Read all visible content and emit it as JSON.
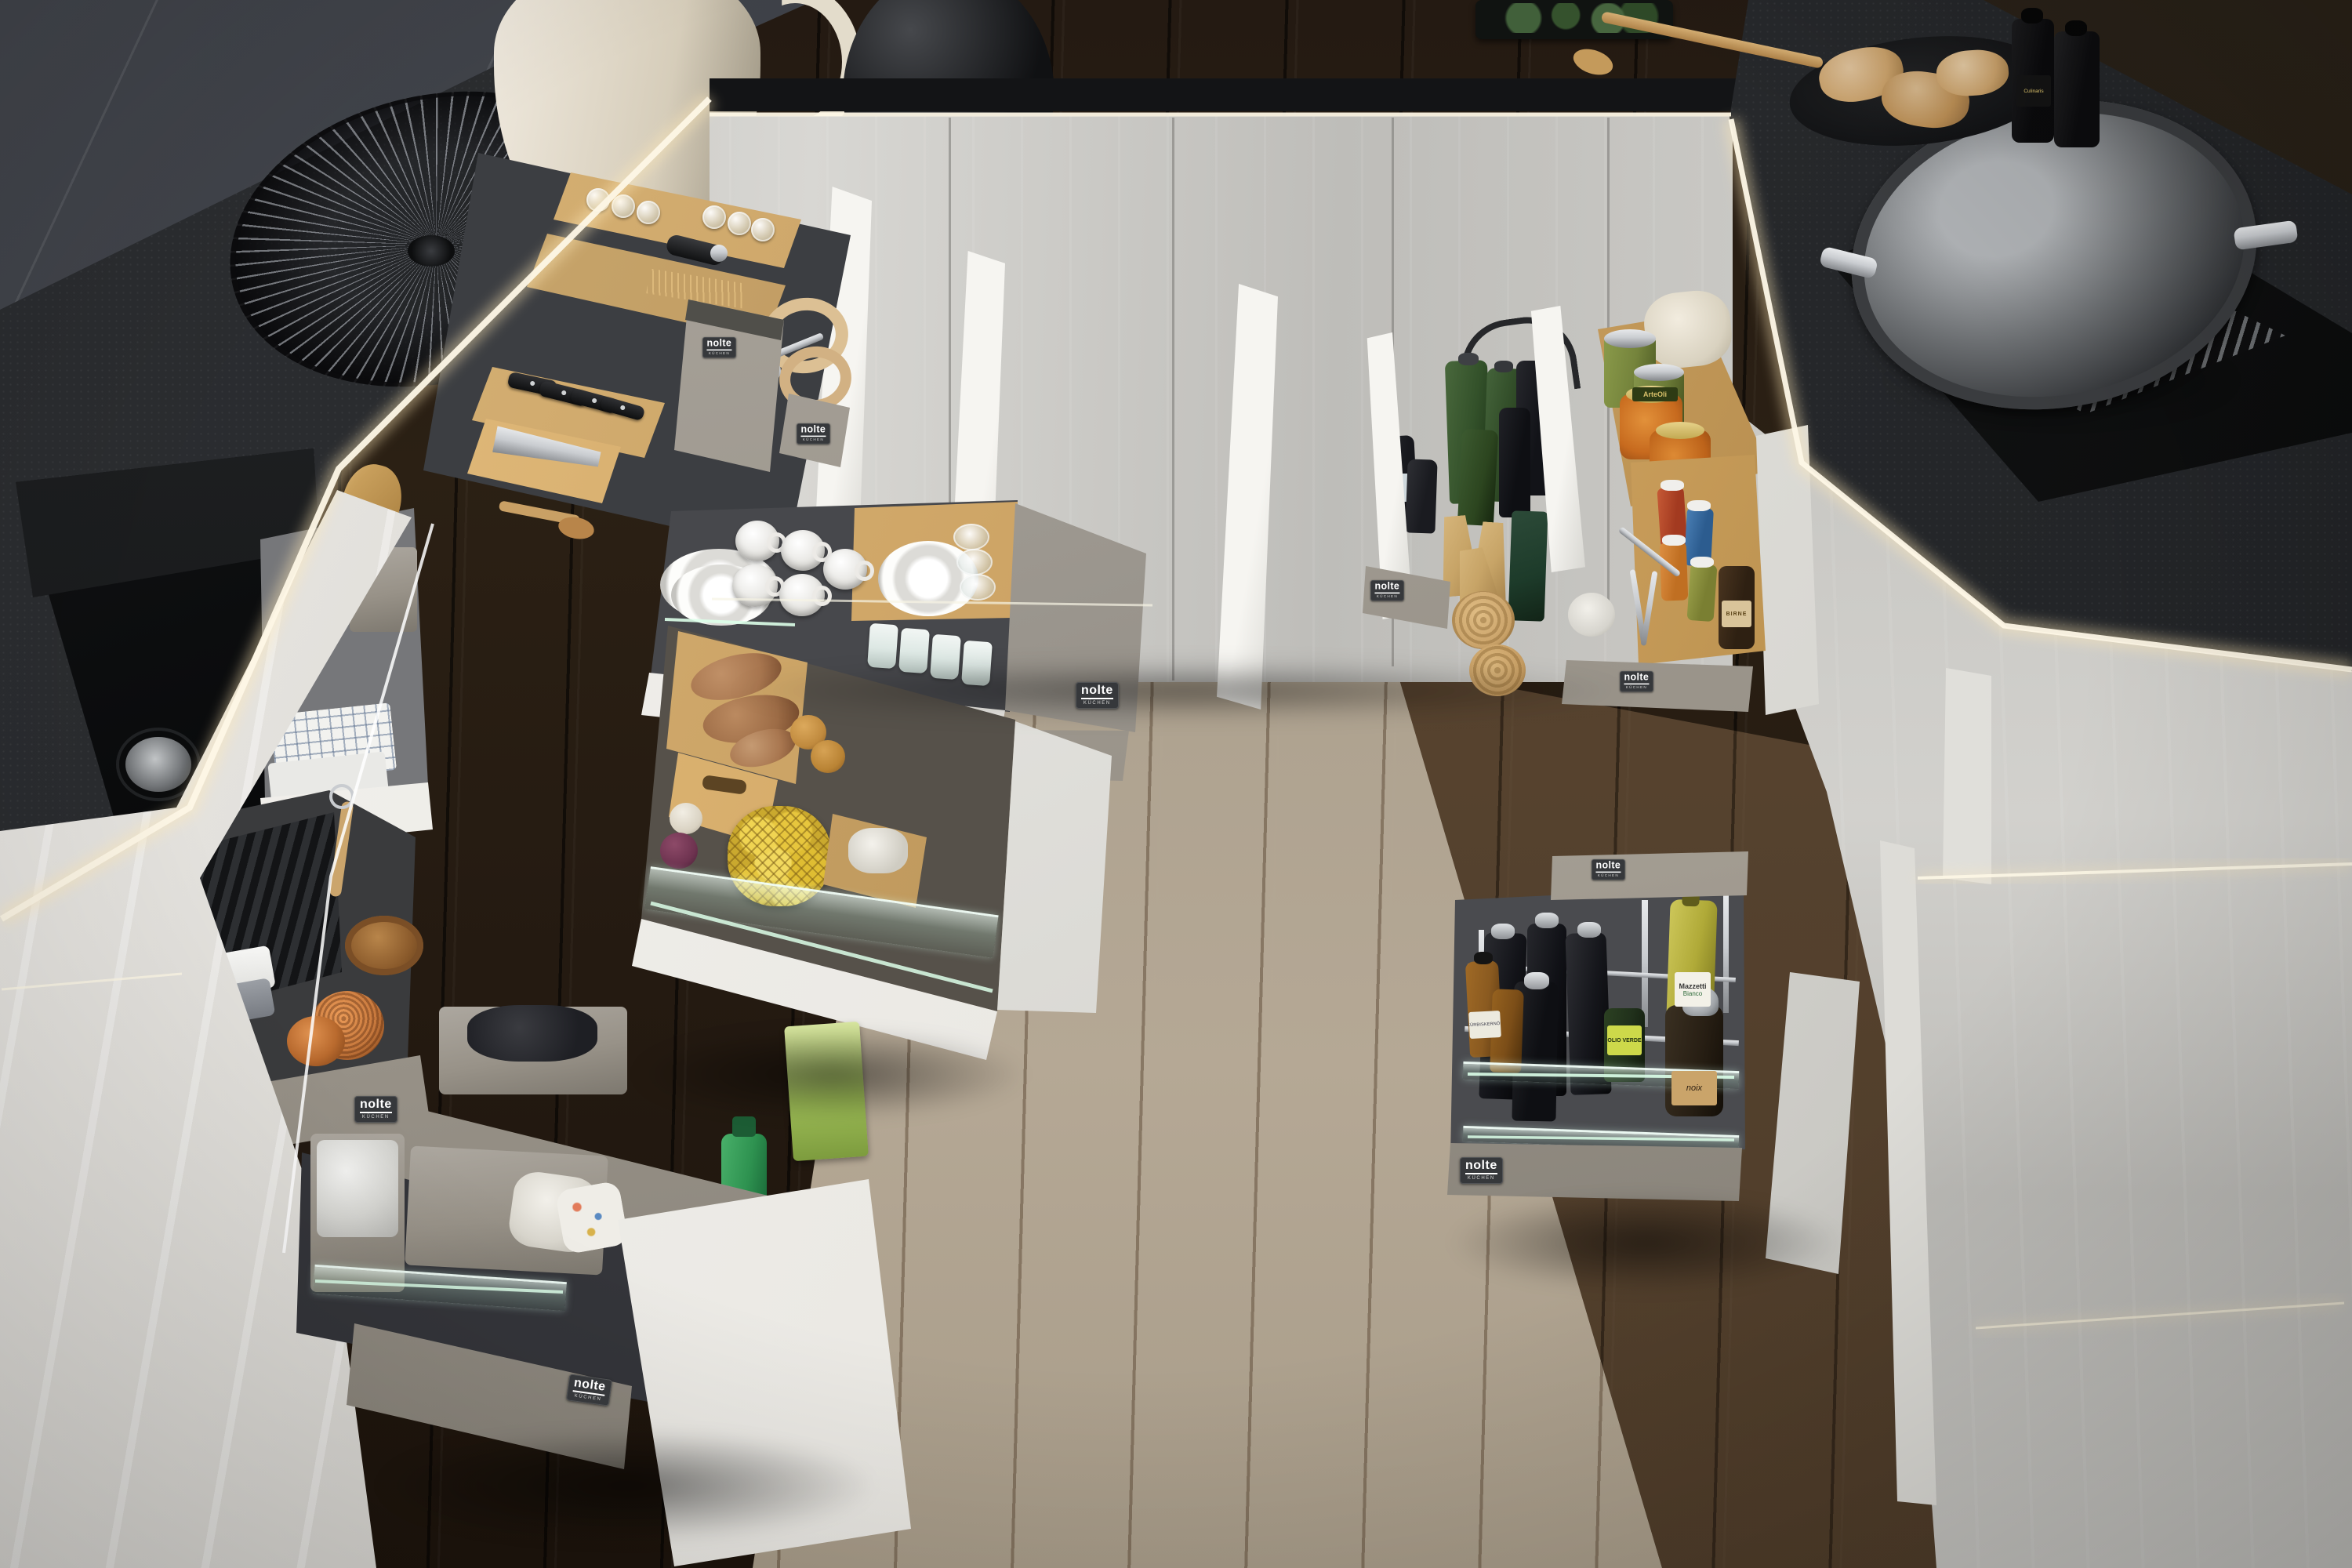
{
  "scene": {
    "subject": "Modern nolte kitchen with all drawers and pull-outs open showing interior organisation",
    "viewpoint": "high angle looking down into a U-shaped kitchen",
    "lighting": "warm LED strips under worktops and inside open cabinet gaps"
  },
  "brand": {
    "name": "nolte",
    "tagline": "KÜCHEN"
  },
  "labels": {
    "white_wine_vinegar_line1": "Mazzetti",
    "white_wine_vinegar_line2": "Bianco",
    "olive_oil": "OLIO VERDE",
    "walnut_oil": "noix",
    "olive_cans": "ArteOli",
    "mustard_jar": "BIRNE",
    "pumpkin_seed_oil": "KÜRBISKERNÖL",
    "soy_sauce": "Culinaris"
  },
  "colors": {
    "counter": "#26282b",
    "wallSlate": "#383b41",
    "wallDark": "#15120e",
    "cabinet": "#c9c8c4",
    "drawerGrey": "#989288",
    "front": "#e9e7e2",
    "wood": "#c49a5b",
    "woodDeep": "#96702f",
    "woodLight": "#dcb97e",
    "mat": "#42444a",
    "led": "#fdf6e0",
    "floor": "#2a1f16",
    "floorLight": "#b5a895",
    "steel": "#c9ccd0",
    "badge": "#36383b",
    "green_bottle": "#33512a",
    "amber": "#8a5a20",
    "lemon": "#e7c63d",
    "copper": "#c97a3e",
    "soap_green": "#2e9250",
    "jam": "#c76a1e",
    "can_green": "#75843c",
    "potato": "#a8764f",
    "onion": "#c08a3e",
    "red_onion": "#6e3350"
  }
}
